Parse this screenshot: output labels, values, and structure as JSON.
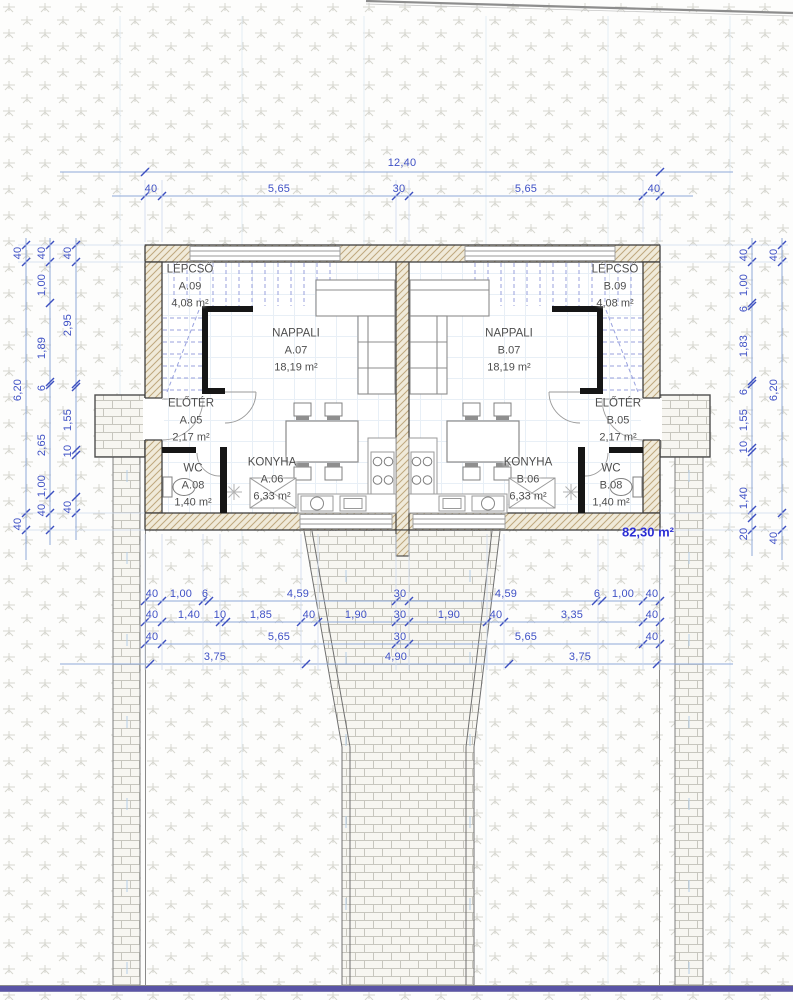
{
  "drawing": {
    "title": "ground-floor-plan-duplex",
    "total_area_label": "82,30 m²",
    "rooms": [
      {
        "unit": "A",
        "id": "A.09",
        "name": "LÉPCSŐ",
        "area": "4,08 m²",
        "cx": 190,
        "cy": 287
      },
      {
        "unit": "A",
        "id": "A.07",
        "name": "NAPPALI",
        "area": "18,19 m²",
        "cx": 296,
        "cy": 351
      },
      {
        "unit": "A",
        "id": "A.05",
        "name": "ELŐTÉR",
        "area": "2,17 m²",
        "cx": 191,
        "cy": 421
      },
      {
        "unit": "A",
        "id": "A.08",
        "name": "WC",
        "area": "1,40 m²",
        "cx": 193,
        "cy": 486
      },
      {
        "unit": "A",
        "id": "A.06",
        "name": "KONYHA",
        "area": "6,33 m²",
        "cx": 272,
        "cy": 480
      },
      {
        "unit": "B",
        "id": "B.09",
        "name": "LÉPCSŐ",
        "area": "4,08 m²",
        "cx": 615,
        "cy": 287
      },
      {
        "unit": "B",
        "id": "B.07",
        "name": "NAPPALI",
        "area": "18,19 m²",
        "cx": 509,
        "cy": 351
      },
      {
        "unit": "B",
        "id": "B.05",
        "name": "ELŐTÉR",
        "area": "2,17 m²",
        "cx": 618,
        "cy": 421
      },
      {
        "unit": "B",
        "id": "B.08",
        "name": "WC",
        "area": "1,40 m²",
        "cx": 611,
        "cy": 486
      },
      {
        "unit": "B",
        "id": "B.06",
        "name": "KONYHA",
        "area": "6,33 m²",
        "cx": 528,
        "cy": 480
      }
    ],
    "dimension_labels": [
      {
        "t": "12,40",
        "x": 402,
        "y": 163
      },
      {
        "t": "40",
        "x": 151,
        "y": 189
      },
      {
        "t": "5,65",
        "x": 279,
        "y": 189
      },
      {
        "t": "30",
        "x": 399,
        "y": 189
      },
      {
        "t": "5,65",
        "x": 526,
        "y": 189
      },
      {
        "t": "40",
        "x": 654,
        "y": 189
      },
      {
        "t": "40",
        "x": 152,
        "y": 594
      },
      {
        "t": "1,00",
        "x": 181,
        "y": 594
      },
      {
        "t": "6",
        "x": 205,
        "y": 594
      },
      {
        "t": "4,59",
        "x": 298,
        "y": 594
      },
      {
        "t": "30",
        "x": 400,
        "y": 594
      },
      {
        "t": "4,59",
        "x": 506,
        "y": 594
      },
      {
        "t": "6",
        "x": 597,
        "y": 594
      },
      {
        "t": "1,00",
        "x": 623,
        "y": 594
      },
      {
        "t": "40",
        "x": 652,
        "y": 594
      },
      {
        "t": "40",
        "x": 152,
        "y": 615
      },
      {
        "t": "1,40",
        "x": 189,
        "y": 615
      },
      {
        "t": "10",
        "x": 220,
        "y": 615
      },
      {
        "t": "1,85",
        "x": 261,
        "y": 615
      },
      {
        "t": "40",
        "x": 309,
        "y": 615
      },
      {
        "t": "1,90",
        "x": 356,
        "y": 615
      },
      {
        "t": "30",
        "x": 400,
        "y": 615
      },
      {
        "t": "1,90",
        "x": 449,
        "y": 615
      },
      {
        "t": "40",
        "x": 496,
        "y": 615
      },
      {
        "t": "3,35",
        "x": 572,
        "y": 615
      },
      {
        "t": "40",
        "x": 652,
        "y": 615
      },
      {
        "t": "40",
        "x": 152,
        "y": 637
      },
      {
        "t": "5,65",
        "x": 279,
        "y": 637
      },
      {
        "t": "30",
        "x": 400,
        "y": 637
      },
      {
        "t": "5,65",
        "x": 526,
        "y": 637
      },
      {
        "t": "40",
        "x": 652,
        "y": 637
      },
      {
        "t": "3,75",
        "x": 215,
        "y": 657
      },
      {
        "t": "4,90",
        "x": 396,
        "y": 657
      },
      {
        "t": "3,75",
        "x": 580,
        "y": 657
      },
      {
        "t": "40",
        "x": 18,
        "y": 253,
        "r": 1
      },
      {
        "t": "6,20",
        "x": 18,
        "y": 390,
        "r": 1
      },
      {
        "t": "40",
        "x": 18,
        "y": 524,
        "r": 1
      },
      {
        "t": "40",
        "x": 42,
        "y": 253,
        "r": 1
      },
      {
        "t": "1,00",
        "x": 42,
        "y": 285,
        "r": 1
      },
      {
        "t": "1,89",
        "x": 42,
        "y": 348,
        "r": 1
      },
      {
        "t": "6",
        "x": 42,
        "y": 388,
        "r": 1
      },
      {
        "t": "2,65",
        "x": 42,
        "y": 445,
        "r": 1
      },
      {
        "t": "1,00",
        "x": 42,
        "y": 486,
        "r": 1
      },
      {
        "t": "40",
        "x": 42,
        "y": 510,
        "r": 1
      },
      {
        "t": "40",
        "x": 68,
        "y": 253,
        "r": 1
      },
      {
        "t": "2,95",
        "x": 68,
        "y": 325,
        "r": 1
      },
      {
        "t": "1,55",
        "x": 68,
        "y": 420,
        "r": 1
      },
      {
        "t": "10",
        "x": 68,
        "y": 451,
        "r": 1
      },
      {
        "t": "40",
        "x": 68,
        "y": 507,
        "r": 1
      },
      {
        "t": "40",
        "x": 744,
        "y": 255,
        "r": 1
      },
      {
        "t": "1,00",
        "x": 744,
        "y": 285,
        "r": 1
      },
      {
        "t": "6",
        "x": 744,
        "y": 309,
        "r": 1
      },
      {
        "t": "1,83",
        "x": 744,
        "y": 346,
        "r": 1
      },
      {
        "t": "6",
        "x": 744,
        "y": 392,
        "r": 1
      },
      {
        "t": "1,55",
        "x": 744,
        "y": 420,
        "r": 1
      },
      {
        "t": "10",
        "x": 744,
        "y": 447,
        "r": 1
      },
      {
        "t": "1,40",
        "x": 744,
        "y": 498,
        "r": 1
      },
      {
        "t": "20",
        "x": 744,
        "y": 534,
        "r": 1
      },
      {
        "t": "40",
        "x": 774,
        "y": 255,
        "r": 1
      },
      {
        "t": "6,20",
        "x": 774,
        "y": 390,
        "r": 1
      },
      {
        "t": "40",
        "x": 774,
        "y": 538,
        "r": 1
      }
    ],
    "colors": {
      "dimension_text": "#3f51c5",
      "dimension_line": "#8fa9d9",
      "room_text": "#4e4e4e",
      "total_area_text": "#2c2fd4",
      "wall_hatch": "#bfa87e",
      "heavy_wall": "#161616",
      "stair_lines": "#98a1de",
      "site_boundary": "#8d8d8d",
      "bottom_band": "#5a54a6"
    }
  }
}
